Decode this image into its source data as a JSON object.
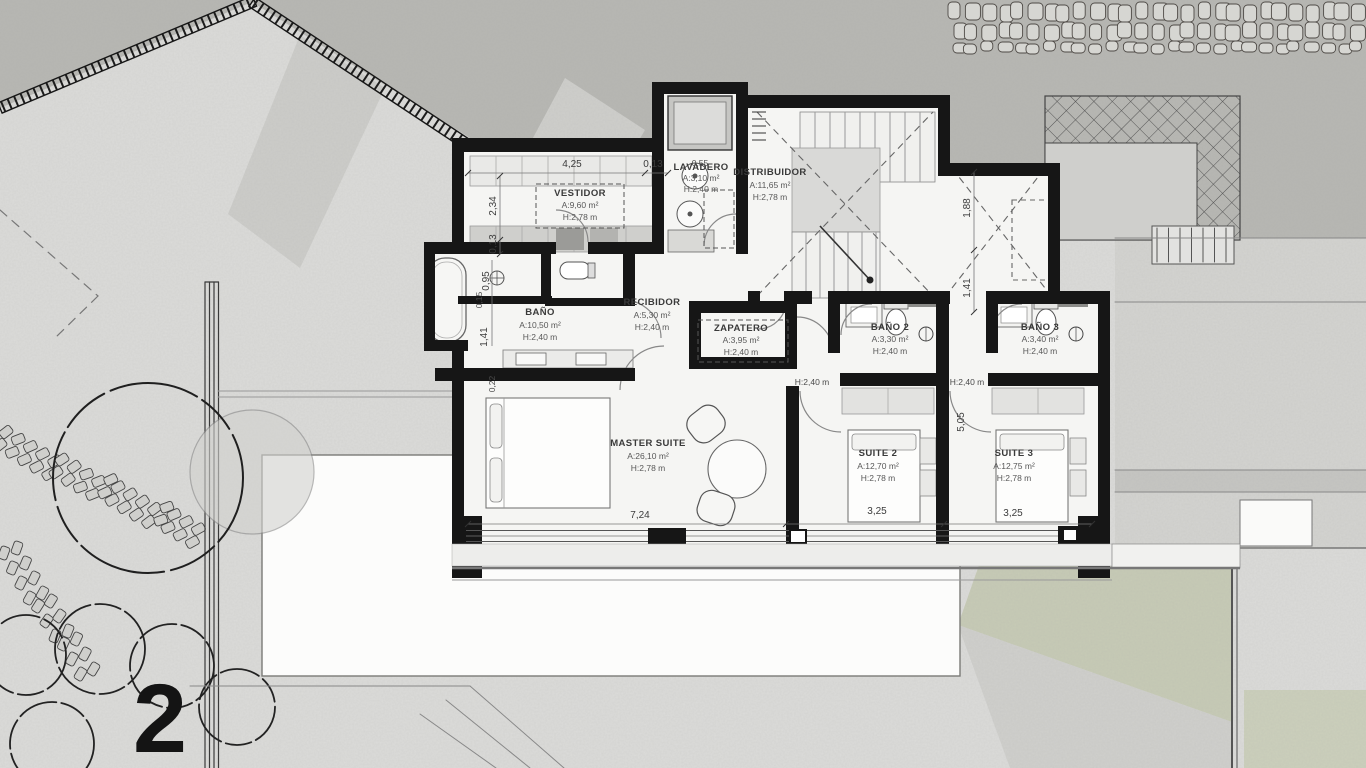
{
  "sheet": {
    "number": "2"
  },
  "palette": {
    "wall": "#161616",
    "site_texture": "#b7b7b3",
    "paper": "#dcdcda",
    "floor": "#f5f5f3",
    "grass": "#c7cbb6",
    "terrace": "#fcfcfb"
  },
  "rooms": [
    {
      "name": "VESTIDOR",
      "area": "A:9,60 m²",
      "height": "H:2,78 m"
    },
    {
      "name": "LAVADERO",
      "area": "A:3,10 m²",
      "height": "H:2,40 m"
    },
    {
      "name": "DISTRIBUIDOR",
      "area": "A:11,65 m²",
      "height": "H:2,78 m"
    },
    {
      "name": "BAÑO",
      "area": "A:10,50 m²",
      "height": "H:2,40 m"
    },
    {
      "name": "RECIBIDOR",
      "area": "A:5,30 m²",
      "height": "H:2,40 m"
    },
    {
      "name": "ZAPATERO",
      "area": "A:3,95 m²",
      "height": "H:2,40 m"
    },
    {
      "name": "BAÑO 2",
      "area": "A:3,30 m²",
      "height": "H:2,40 m"
    },
    {
      "name": "BAÑO 3",
      "area": "A:3,40 m²",
      "height": "H:2,40 m"
    },
    {
      "name": "MASTER SUITE",
      "area": "A:26,10 m²",
      "height": "H:2,78 m"
    },
    {
      "name": "SUITE 2",
      "area": "A:12,70 m²",
      "height": "H:2,78 m"
    },
    {
      "name": "SUITE 3",
      "area": "A:12,75 m²",
      "height": "H:2,78 m"
    }
  ],
  "dims": {
    "top": [
      "4,25",
      "0,13",
      "0,55"
    ],
    "left": [
      "2,34",
      "0,13",
      "0,95",
      "0,15",
      "1,41",
      "0,22"
    ],
    "right": [
      "1,88",
      "1,41",
      "5,05"
    ],
    "bottom": [
      "7,24",
      "3,25",
      "3,25"
    ],
    "heights": [
      "H:2,40 m",
      "H:2,40 m"
    ]
  }
}
